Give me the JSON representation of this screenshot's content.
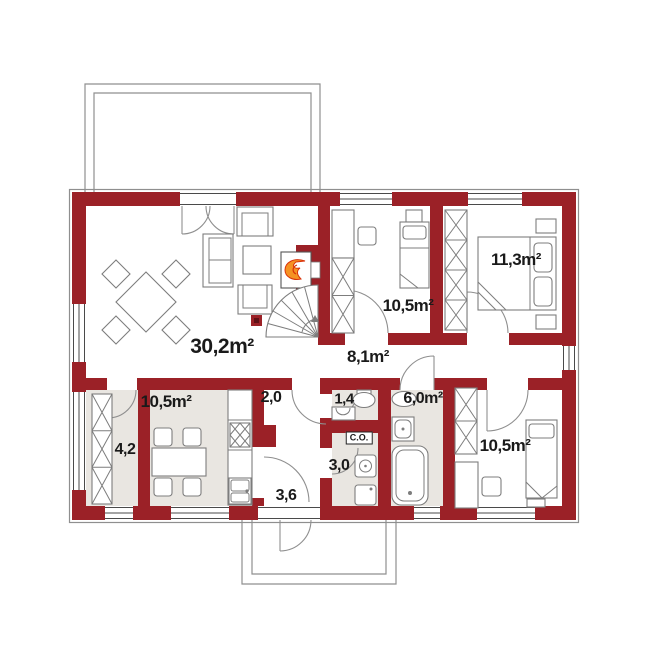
{
  "meta": {
    "title": "House ground floor plan"
  },
  "colors": {
    "wall": "#9b2127",
    "floor": "#e9e6e1",
    "line": "#7d7d7d",
    "outline": "#8f8f8f",
    "text": "#1a1a1a",
    "flame": "#f59223",
    "flame_dark": "#d9330a"
  },
  "rooms": [
    {
      "id": "living-room",
      "label": "30,2m²"
    },
    {
      "id": "kitchen",
      "label": "10,5m²"
    },
    {
      "id": "pantry",
      "label": "4,2"
    },
    {
      "id": "hall",
      "label": "8,1m²"
    },
    {
      "id": "vestibule",
      "label": "2,0"
    },
    {
      "id": "corridor",
      "label": "3,6"
    },
    {
      "id": "wc",
      "label": "1,4"
    },
    {
      "id": "bathroom",
      "label": "6,0m²"
    },
    {
      "id": "utility-room",
      "label": "3,0"
    },
    {
      "id": "bedroom-top",
      "label": "10,5m²"
    },
    {
      "id": "bedroom-right",
      "label": "11,3m²"
    },
    {
      "id": "bedroom-bottom",
      "label": "10,5m²"
    }
  ],
  "annotations": {
    "boiler_box": "C.O."
  },
  "features": [
    "fireplace-icon",
    "spiral-stairs-icon",
    "wardrobe-icon",
    "bed-icon",
    "dining-table-icon",
    "sofa-icon",
    "bathtub-icon",
    "toilet-icon",
    "sink-icon",
    "stove-icon",
    "window-icon",
    "door-swing-icon",
    "terrace-outline",
    "porch-outline"
  ]
}
